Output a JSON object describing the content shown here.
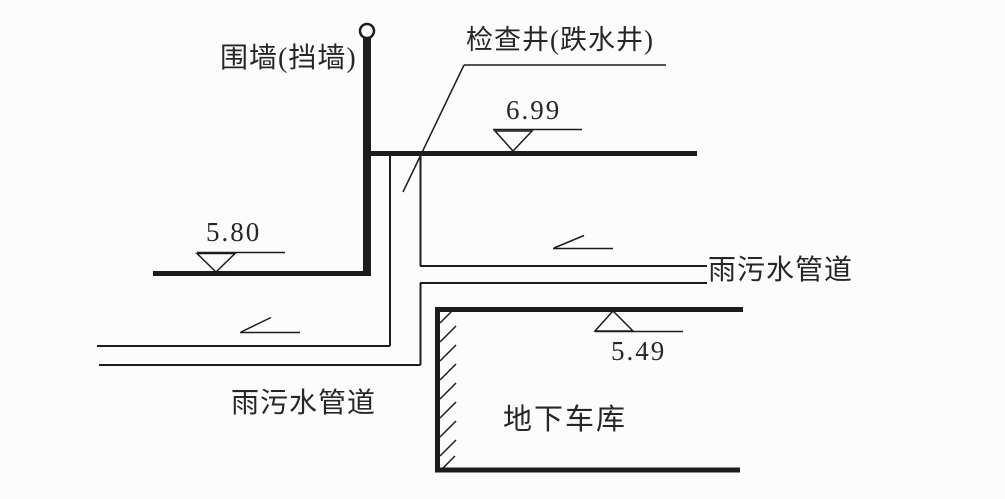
{
  "diagram": {
    "labels": {
      "retaining_wall": "围墙(挡墙)",
      "inspection_well": "检查井(跌水井)",
      "pipe_right": "雨污水管道",
      "pipe_left": "雨污水管道",
      "underground_garage": "地下车库"
    },
    "elevations": {
      "ground_upper": "6.99",
      "ground_left": "5.80",
      "garage_roof": "5.49"
    },
    "colors": {
      "line": "#1c1c1c",
      "background": "#fcfcfc",
      "text": "#262626"
    }
  }
}
